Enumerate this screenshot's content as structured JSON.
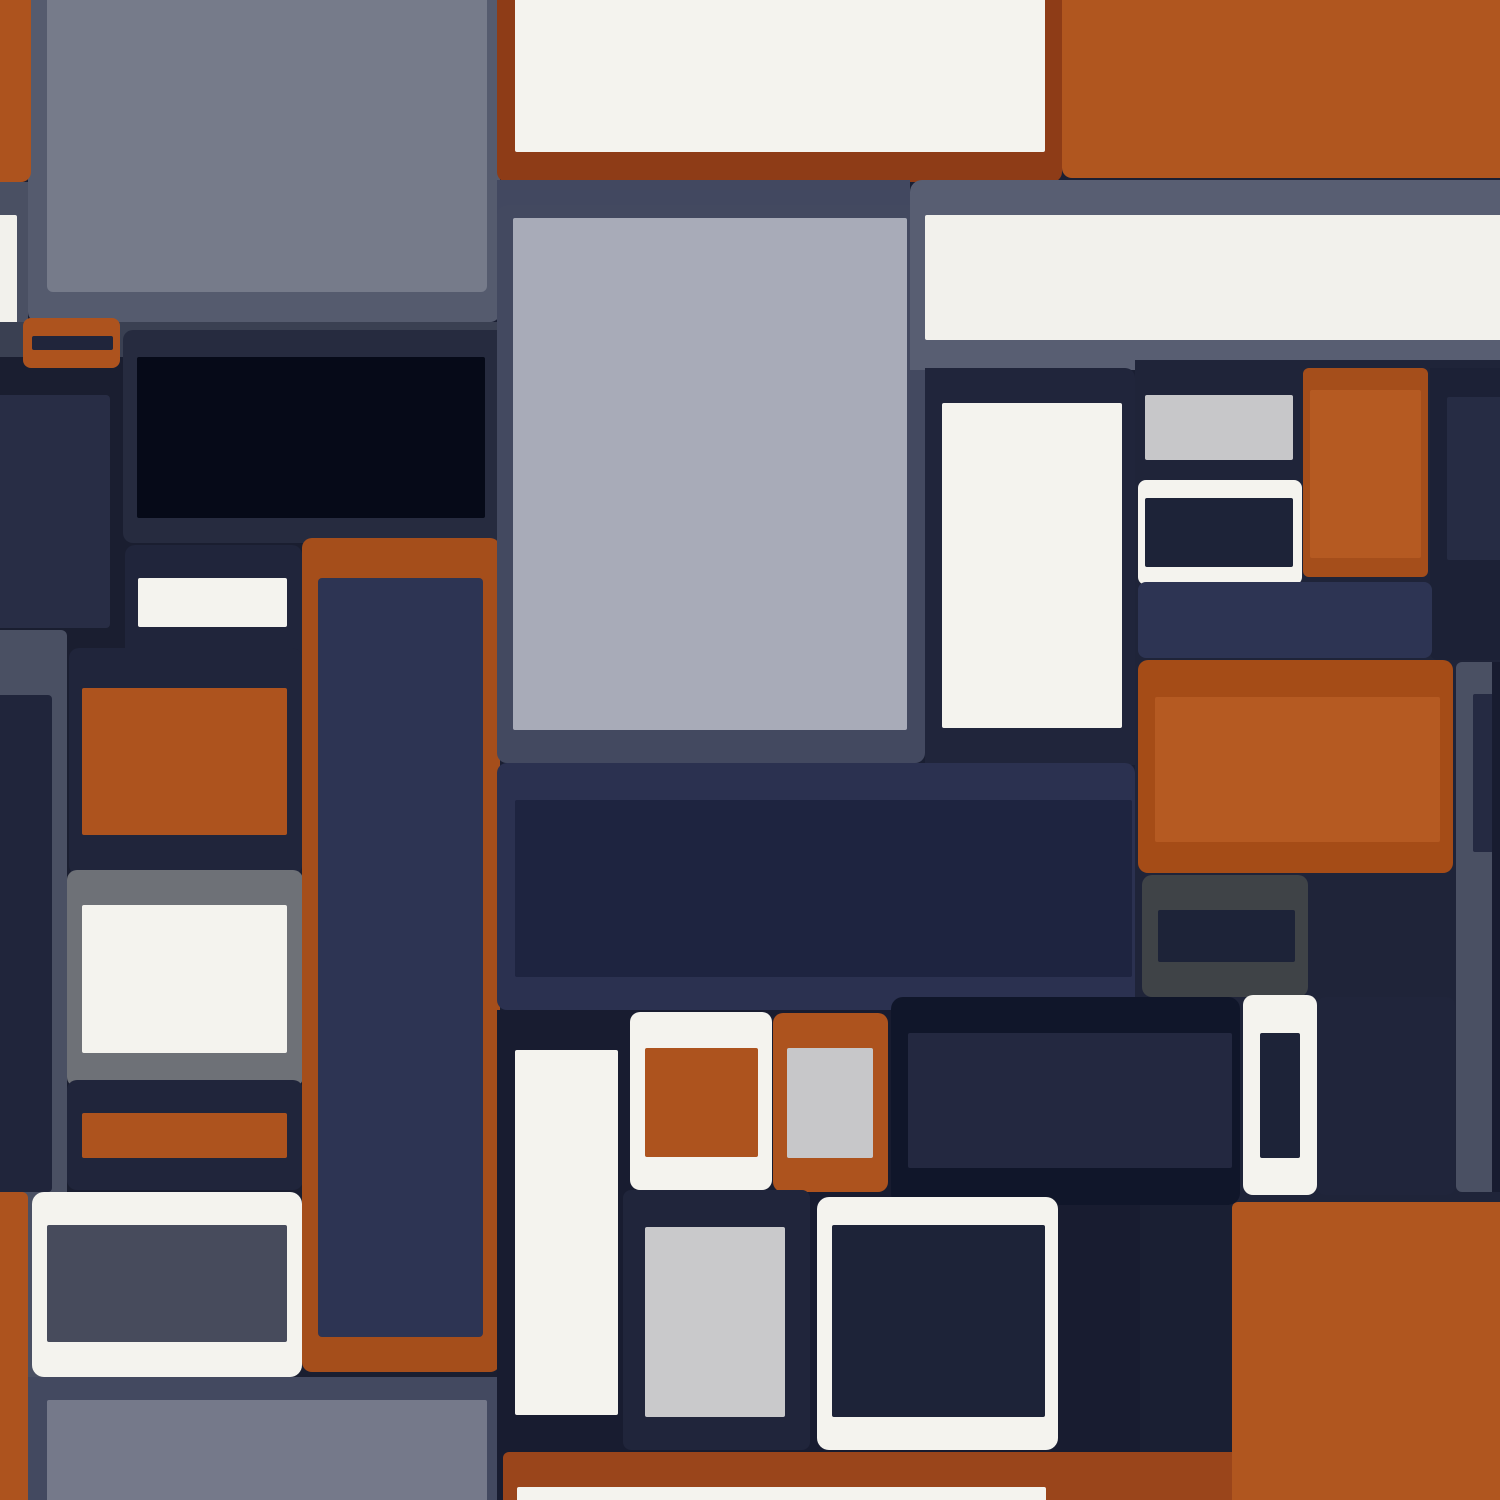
{
  "meta": {
    "title": "abstract-rectangle-mosaic-pattern",
    "description": "Seamless abstract pattern of rounded rectangles resembling stacked UI cards in navy, slate, rust-orange and off-white"
  },
  "canvas": {
    "width": 1500,
    "height": 1500,
    "background": "#1a1f33"
  },
  "palette": {
    "base_navy": "#1a1f33",
    "panel_navy": "#20253b",
    "medium_navy": "#2d3453",
    "near_black": "#060a18",
    "slate": "#434960",
    "light_slate": "#555b6e",
    "orange": "#ad531e",
    "bright_orange": "#b0561f",
    "dark_rust": "#8e3c17",
    "off_white": "#f4f3ee",
    "silver": "#a8abb8",
    "gray": "#767b8a"
  },
  "shapes": [
    {
      "name": "base-background",
      "x": 0,
      "y": 0,
      "w": 1500,
      "h": 1500,
      "color": "#1a1f33",
      "r": "0"
    },
    {
      "name": "tl-slate-panel",
      "x": 28,
      "y": 0,
      "w": 472,
      "h": 322,
      "color": "#555b6e",
      "r": "0 0 10px 10px"
    },
    {
      "name": "tl-gray-rect",
      "x": 47,
      "y": 0,
      "w": 440,
      "h": 292,
      "color": "#767b8a",
      "r": "0 0 6px 6px"
    },
    {
      "name": "tl-orange-strip",
      "x": 0,
      "y": 0,
      "w": 31,
      "h": 182,
      "color": "#ad531e",
      "r": "0 0 10px 0"
    },
    {
      "name": "tl-slate-left-strip",
      "x": 0,
      "y": 182,
      "w": 28,
      "h": 178,
      "color": "#4a5063",
      "r": "0"
    },
    {
      "name": "tl-white-strip",
      "x": 0,
      "y": 215,
      "w": 17,
      "h": 127,
      "color": "#f2f1ec",
      "r": "0 2px 2px 0"
    },
    {
      "name": "left-dark-band",
      "x": 0,
      "y": 322,
      "w": 500,
      "h": 38,
      "color": "#3a4052",
      "r": "0"
    },
    {
      "name": "left-dark-background",
      "x": 0,
      "y": 357,
      "w": 500,
      "h": 1143,
      "color": "#1a1e30",
      "r": "0"
    },
    {
      "name": "black-frame-panel",
      "x": 123,
      "y": 330,
      "w": 377,
      "h": 213,
      "color": "#262b3f",
      "r": "10px 0 0 10px"
    },
    {
      "name": "black-rect",
      "x": 137,
      "y": 357,
      "w": 348,
      "h": 161,
      "color": "#060a18",
      "r": "2px"
    },
    {
      "name": "left-mini-navy-rect",
      "x": 0,
      "y": 395,
      "w": 110,
      "h": 233,
      "color": "#282d45",
      "r": "0 4px 4px 0"
    },
    {
      "name": "orange-tab",
      "x": 23,
      "y": 318,
      "w": 97,
      "h": 50,
      "color": "#ad531e",
      "r": "8px"
    },
    {
      "name": "orange-tab-stripe",
      "x": 32,
      "y": 336,
      "w": 81,
      "h": 14,
      "color": "#20253b",
      "r": "2px"
    },
    {
      "name": "white-card-panel",
      "x": 125,
      "y": 545,
      "w": 177,
      "h": 155,
      "color": "#20253b",
      "r": "10px"
    },
    {
      "name": "white-card-rect",
      "x": 138,
      "y": 578,
      "w": 149,
      "h": 49,
      "color": "#f4f3ee",
      "r": "2px"
    },
    {
      "name": "left-slate-column",
      "x": 0,
      "y": 630,
      "w": 67,
      "h": 747,
      "color": "#4a5063",
      "r": "0 6px 6px 0"
    },
    {
      "name": "left-navy-column",
      "x": 0,
      "y": 695,
      "w": 52,
      "h": 497,
      "color": "#20253b",
      "r": "0 4px 4px 0"
    },
    {
      "name": "orange-card-panel",
      "x": 69,
      "y": 648,
      "w": 233,
      "h": 227,
      "color": "#20253b",
      "r": "10px"
    },
    {
      "name": "orange-card-rect",
      "x": 82,
      "y": 688,
      "w": 205,
      "h": 147,
      "color": "#ad531e",
      "r": "2px"
    },
    {
      "name": "gray-card-panel",
      "x": 67,
      "y": 870,
      "w": 236,
      "h": 217,
      "color": "#6e7177",
      "r": "10px"
    },
    {
      "name": "gray-card-white-rect",
      "x": 82,
      "y": 905,
      "w": 205,
      "h": 148,
      "color": "#f4f3ee",
      "r": "2px"
    },
    {
      "name": "navy-stripe-panel",
      "x": 67,
      "y": 1080,
      "w": 236,
      "h": 110,
      "color": "#20253b",
      "r": "10px"
    },
    {
      "name": "orange-stripe-rect",
      "x": 82,
      "y": 1113,
      "w": 205,
      "h": 45,
      "color": "#ad531e",
      "r": "2px"
    },
    {
      "name": "bottom-left-slate",
      "x": 28,
      "y": 1377,
      "w": 472,
      "h": 123,
      "color": "#434960",
      "r": "0"
    },
    {
      "name": "bottom-left-gray-rect",
      "x": 47,
      "y": 1400,
      "w": 440,
      "h": 100,
      "color": "#75798a",
      "r": "2px 2px 0 0"
    },
    {
      "name": "bottom-white-panel",
      "x": 32,
      "y": 1192,
      "w": 270,
      "h": 185,
      "color": "#f4f3ee",
      "r": "12px"
    },
    {
      "name": "bottom-slate-inner",
      "x": 47,
      "y": 1225,
      "w": 240,
      "h": 117,
      "color": "#474b5c",
      "r": "2px"
    },
    {
      "name": "left-orange-edge",
      "x": 0,
      "y": 1192,
      "w": 28,
      "h": 308,
      "color": "#ad531e",
      "r": "0 6px 0 0"
    },
    {
      "name": "tall-orange-frame",
      "x": 302,
      "y": 538,
      "w": 198,
      "h": 834,
      "color": "#a54e1b",
      "r": "10px"
    },
    {
      "name": "tall-navy-rect",
      "x": 318,
      "y": 578,
      "w": 165,
      "h": 759,
      "color": "#2d3453",
      "r": "4px"
    },
    {
      "name": "top-rust-frame",
      "x": 497,
      "y": 0,
      "w": 565,
      "h": 182,
      "color": "#8e3c17",
      "r": "0 0 10px 10px"
    },
    {
      "name": "top-white-rect",
      "x": 515,
      "y": 0,
      "w": 530,
      "h": 152,
      "color": "#f4f3ee",
      "r": "0 0 2px 2px"
    },
    {
      "name": "top-right-orange-rect",
      "x": 1062,
      "y": 0,
      "w": 438,
      "h": 178,
      "color": "#b0561f",
      "r": "0 0 0 10px"
    },
    {
      "name": "band-under-rust",
      "x": 497,
      "y": 180,
      "w": 413,
      "h": 38,
      "color": "#424860",
      "r": "0"
    },
    {
      "name": "center-slate-frame",
      "x": 497,
      "y": 205,
      "w": 428,
      "h": 558,
      "color": "#434960",
      "r": "10px"
    },
    {
      "name": "top-right-slate-panel",
      "x": 910,
      "y": 180,
      "w": 590,
      "h": 190,
      "color": "#585e72",
      "r": "12px 0 0 0"
    },
    {
      "name": "top-right-white-band",
      "x": 925,
      "y": 215,
      "w": 575,
      "h": 125,
      "color": "#f2f1ec",
      "r": "2px 0 0 2px"
    },
    {
      "name": "silver-square",
      "x": 513,
      "y": 218,
      "w": 394,
      "h": 512,
      "color": "#a8abb8",
      "r": "2px"
    },
    {
      "name": "center-navy-panel",
      "x": 925,
      "y": 368,
      "w": 210,
      "h": 397,
      "color": "#20253b",
      "r": "0 10px 0 0"
    },
    {
      "name": "center-white-rect",
      "x": 942,
      "y": 403,
      "w": 180,
      "h": 325,
      "color": "#f4f3ee",
      "r": "2px"
    },
    {
      "name": "right-backdrop",
      "x": 1135,
      "y": 360,
      "w": 365,
      "h": 845,
      "color": "#1f2439",
      "r": "0"
    },
    {
      "name": "right-corner-panel",
      "x": 1430,
      "y": 368,
      "w": 70,
      "h": 292,
      "color": "#1c2136",
      "r": "0 0 0 8px"
    },
    {
      "name": "right-corner-inner",
      "x": 1447,
      "y": 397,
      "w": 53,
      "h": 163,
      "color": "#262c44",
      "r": "2px 0 0 2px"
    },
    {
      "name": "right-gray-rect",
      "x": 1145,
      "y": 395,
      "w": 148,
      "h": 65,
      "color": "#c7c7c9",
      "r": "2px"
    },
    {
      "name": "right-white-frame",
      "x": 1138,
      "y": 480,
      "w": 164,
      "h": 105,
      "color": "#f4f3ee",
      "r": "8px"
    },
    {
      "name": "right-white-frame-inner",
      "x": 1145,
      "y": 498,
      "w": 148,
      "h": 69,
      "color": "#1d2338",
      "r": "2px"
    },
    {
      "name": "right-orange-tall",
      "x": 1303,
      "y": 368,
      "w": 125,
      "h": 209,
      "color": "#a54e1b",
      "r": "6px"
    },
    {
      "name": "right-orange-tall-inner",
      "x": 1310,
      "y": 390,
      "w": 111,
      "h": 168,
      "color": "#b55a22",
      "r": "2px"
    },
    {
      "name": "right-navy-band",
      "x": 1138,
      "y": 582,
      "w": 294,
      "h": 76,
      "color": "#2d3453",
      "r": "8px"
    },
    {
      "name": "right-orange-panel",
      "x": 1138,
      "y": 660,
      "w": 315,
      "h": 213,
      "color": "#a54c17",
      "r": "10px"
    },
    {
      "name": "right-orange-panel-inner",
      "x": 1155,
      "y": 697,
      "w": 285,
      "h": 145,
      "color": "#b55a22",
      "r": "2px"
    },
    {
      "name": "right-slate-bar",
      "x": 1456,
      "y": 662,
      "w": 36,
      "h": 530,
      "color": "#4a5063",
      "r": "6px 0 0 6px"
    },
    {
      "name": "right-slate-bar-inner",
      "x": 1473,
      "y": 694,
      "w": 19,
      "h": 158,
      "color": "#252a42",
      "r": "2px 0 0 2px"
    },
    {
      "name": "far-right-strip",
      "x": 1492,
      "y": 662,
      "w": 8,
      "h": 530,
      "color": "#181c30",
      "r": "0"
    },
    {
      "name": "center-bottom-panel",
      "x": 497,
      "y": 763,
      "w": 638,
      "h": 247,
      "color": "#2b3150",
      "r": "10px"
    },
    {
      "name": "center-bottom-inner",
      "x": 515,
      "y": 800,
      "w": 617,
      "h": 177,
      "color": "#1e2440",
      "r": "2px"
    },
    {
      "name": "center-bottom-background",
      "x": 497,
      "y": 1010,
      "w": 643,
      "h": 490,
      "color": "#181c30",
      "r": "0"
    },
    {
      "name": "darkgray-panel",
      "x": 1142,
      "y": 875,
      "w": 166,
      "h": 122,
      "color": "#3f4347",
      "r": "10px"
    },
    {
      "name": "darkgray-panel-inner",
      "x": 1158,
      "y": 910,
      "w": 137,
      "h": 52,
      "color": "#1d2338",
      "r": "2px"
    },
    {
      "name": "big-dark-panel",
      "x": 891,
      "y": 997,
      "w": 349,
      "h": 208,
      "color": "#10162a",
      "r": "12px"
    },
    {
      "name": "big-dark-panel-inner",
      "x": 908,
      "y": 1033,
      "w": 324,
      "h": 135,
      "color": "#232840",
      "r": "2px"
    },
    {
      "name": "white-slot-element",
      "x": 1243,
      "y": 995,
      "w": 74,
      "h": 200,
      "color": "#f4f3ee",
      "r": "10px"
    },
    {
      "name": "white-slot-inner",
      "x": 1260,
      "y": 1033,
      "w": 40,
      "h": 125,
      "color": "#1d2338",
      "r": "2px"
    },
    {
      "name": "bottom-right-navy-panel",
      "x": 1317,
      "y": 997,
      "w": 138,
      "h": 198,
      "color": "#20253b",
      "r": "8px"
    },
    {
      "name": "bottom-right-orange-field",
      "x": 1232,
      "y": 1202,
      "w": 268,
      "h": 298,
      "color": "#b0561f",
      "r": "6px 0 0 0"
    },
    {
      "name": "bottom-offwhite-tall",
      "x": 515,
      "y": 1050,
      "w": 103,
      "h": 365,
      "color": "#f4f3ee",
      "r": "2px"
    },
    {
      "name": "white-square-panel",
      "x": 630,
      "y": 1012,
      "w": 142,
      "h": 178,
      "color": "#f4f3ee",
      "r": "10px"
    },
    {
      "name": "orange-square",
      "x": 645,
      "y": 1048,
      "w": 113,
      "h": 109,
      "color": "#ad531e",
      "r": "2px"
    },
    {
      "name": "orange-square-panel",
      "x": 773,
      "y": 1013,
      "w": 115,
      "h": 179,
      "color": "#ad531e",
      "r": "10px"
    },
    {
      "name": "gray-square",
      "x": 787,
      "y": 1048,
      "w": 86,
      "h": 110,
      "color": "#c7c7c9",
      "r": "2px"
    },
    {
      "name": "bottom-navy-panel",
      "x": 623,
      "y": 1190,
      "w": 187,
      "h": 260,
      "color": "#20253b",
      "r": "8px"
    },
    {
      "name": "bottom-lightgray-rect",
      "x": 645,
      "y": 1227,
      "w": 140,
      "h": 190,
      "color": "#c9c9cb",
      "r": "2px"
    },
    {
      "name": "bottom-white-frame",
      "x": 817,
      "y": 1197,
      "w": 241,
      "h": 253,
      "color": "#f4f3ee",
      "r": "12px"
    },
    {
      "name": "bottom-white-frame-inner",
      "x": 832,
      "y": 1225,
      "w": 213,
      "h": 192,
      "color": "#1d2338",
      "r": "2px"
    },
    {
      "name": "bottom-orange-band",
      "x": 503,
      "y": 1452,
      "w": 729,
      "h": 48,
      "color": "#9a451b",
      "r": "6px 0 0 0"
    },
    {
      "name": "bottom-offwhite-band",
      "x": 517,
      "y": 1487,
      "w": 529,
      "h": 13,
      "color": "#f4f3ee",
      "r": "2px 2px 0 0"
    }
  ]
}
